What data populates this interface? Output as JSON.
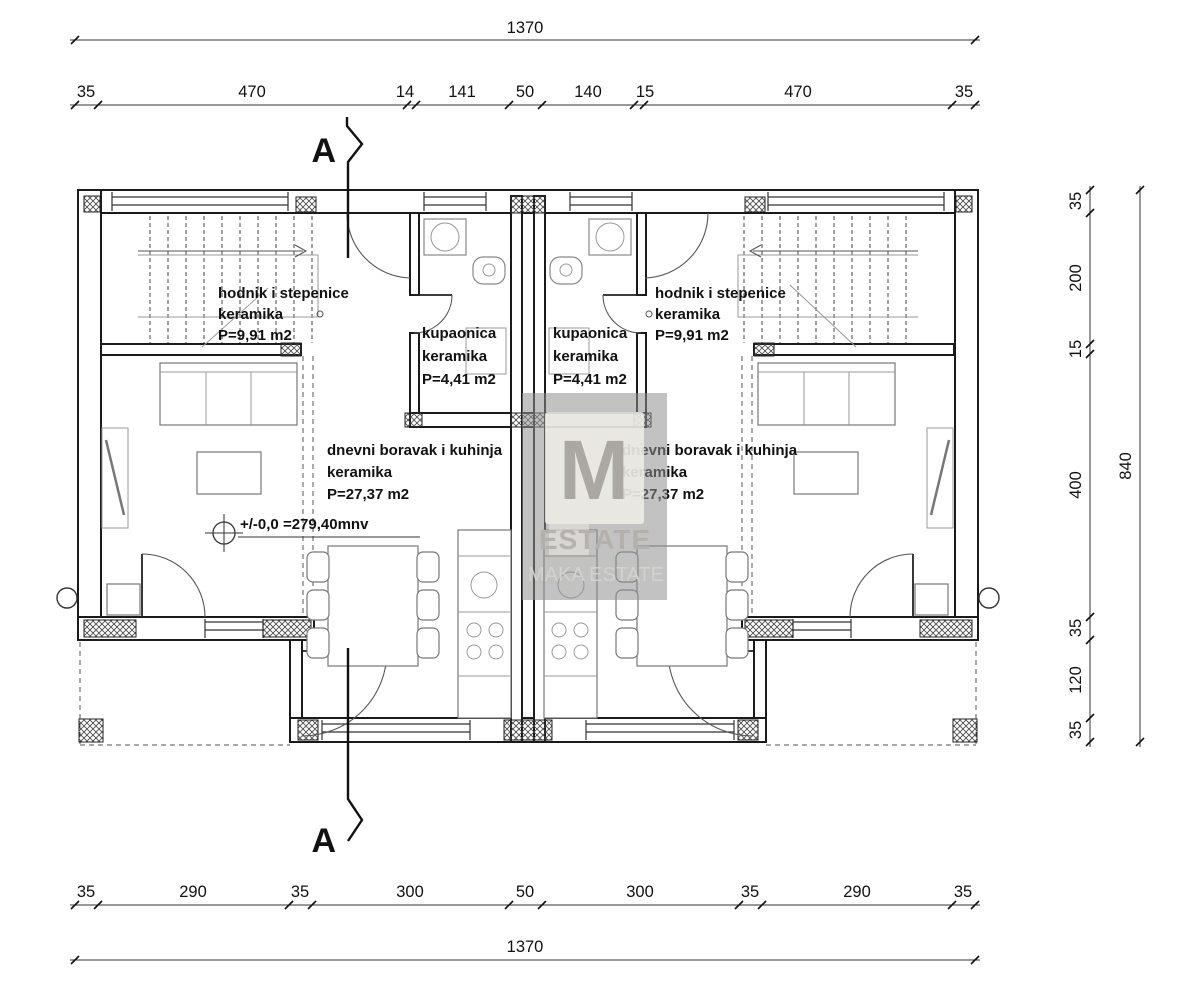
{
  "drawing": {
    "section_label": "A",
    "level_note": "+/-0,0 =279,40mnv"
  },
  "rooms": {
    "hallway": {
      "name": "hodnik i stepenice",
      "finish": "keramika",
      "area": "P=9,91 m2"
    },
    "bathroom": {
      "name": "kupaonica",
      "finish": "keramika",
      "area": "P=4,41 m2"
    },
    "living": {
      "name": "dnevni boravak i kuhinja",
      "finish": "keramika",
      "area": "P=27,37 m2"
    }
  },
  "dimensions": {
    "top_total": "1370",
    "top_segments": [
      "35",
      "470",
      "14",
      "141",
      "50",
      "140",
      "15",
      "470",
      "35"
    ],
    "right_segments": [
      "35",
      "200",
      "15",
      "400",
      "35",
      "120",
      "35"
    ],
    "right_total": "840",
    "bottom_segments": [
      "35",
      "290",
      "35",
      "300",
      "50",
      "300",
      "35",
      "290",
      "35"
    ],
    "bottom_total": "1370"
  },
  "watermark": {
    "monogram": "M",
    "brand": "ESTATE",
    "subbrand": "MAKA ESTATE"
  }
}
